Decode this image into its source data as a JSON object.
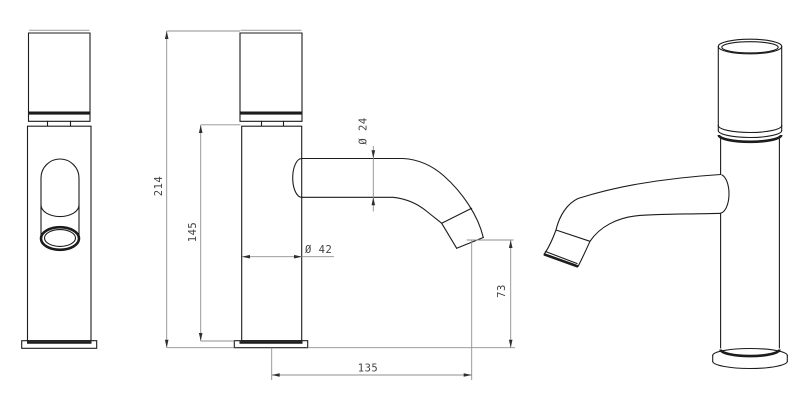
{
  "drawing": {
    "kind": "technical-dimension-drawing",
    "subject": "single-hole basin faucet with curved spout",
    "background": "#ffffff",
    "object_line_color": "#1c1c1c",
    "dimension_line_color": "#8f8f8f",
    "arrow_color": "#2e2e2e",
    "text_color": "#424242",
    "views": {
      "front": "front orthographic view",
      "side": "side orthographic view with dimensions",
      "perspective": "isometric view"
    },
    "dimensions": {
      "overall_height": "214",
      "body_height": "145",
      "body_diameter": "Ø 42",
      "spout_diameter": "Ø 24",
      "outlet_height": "73",
      "spout_reach": "135"
    }
  }
}
